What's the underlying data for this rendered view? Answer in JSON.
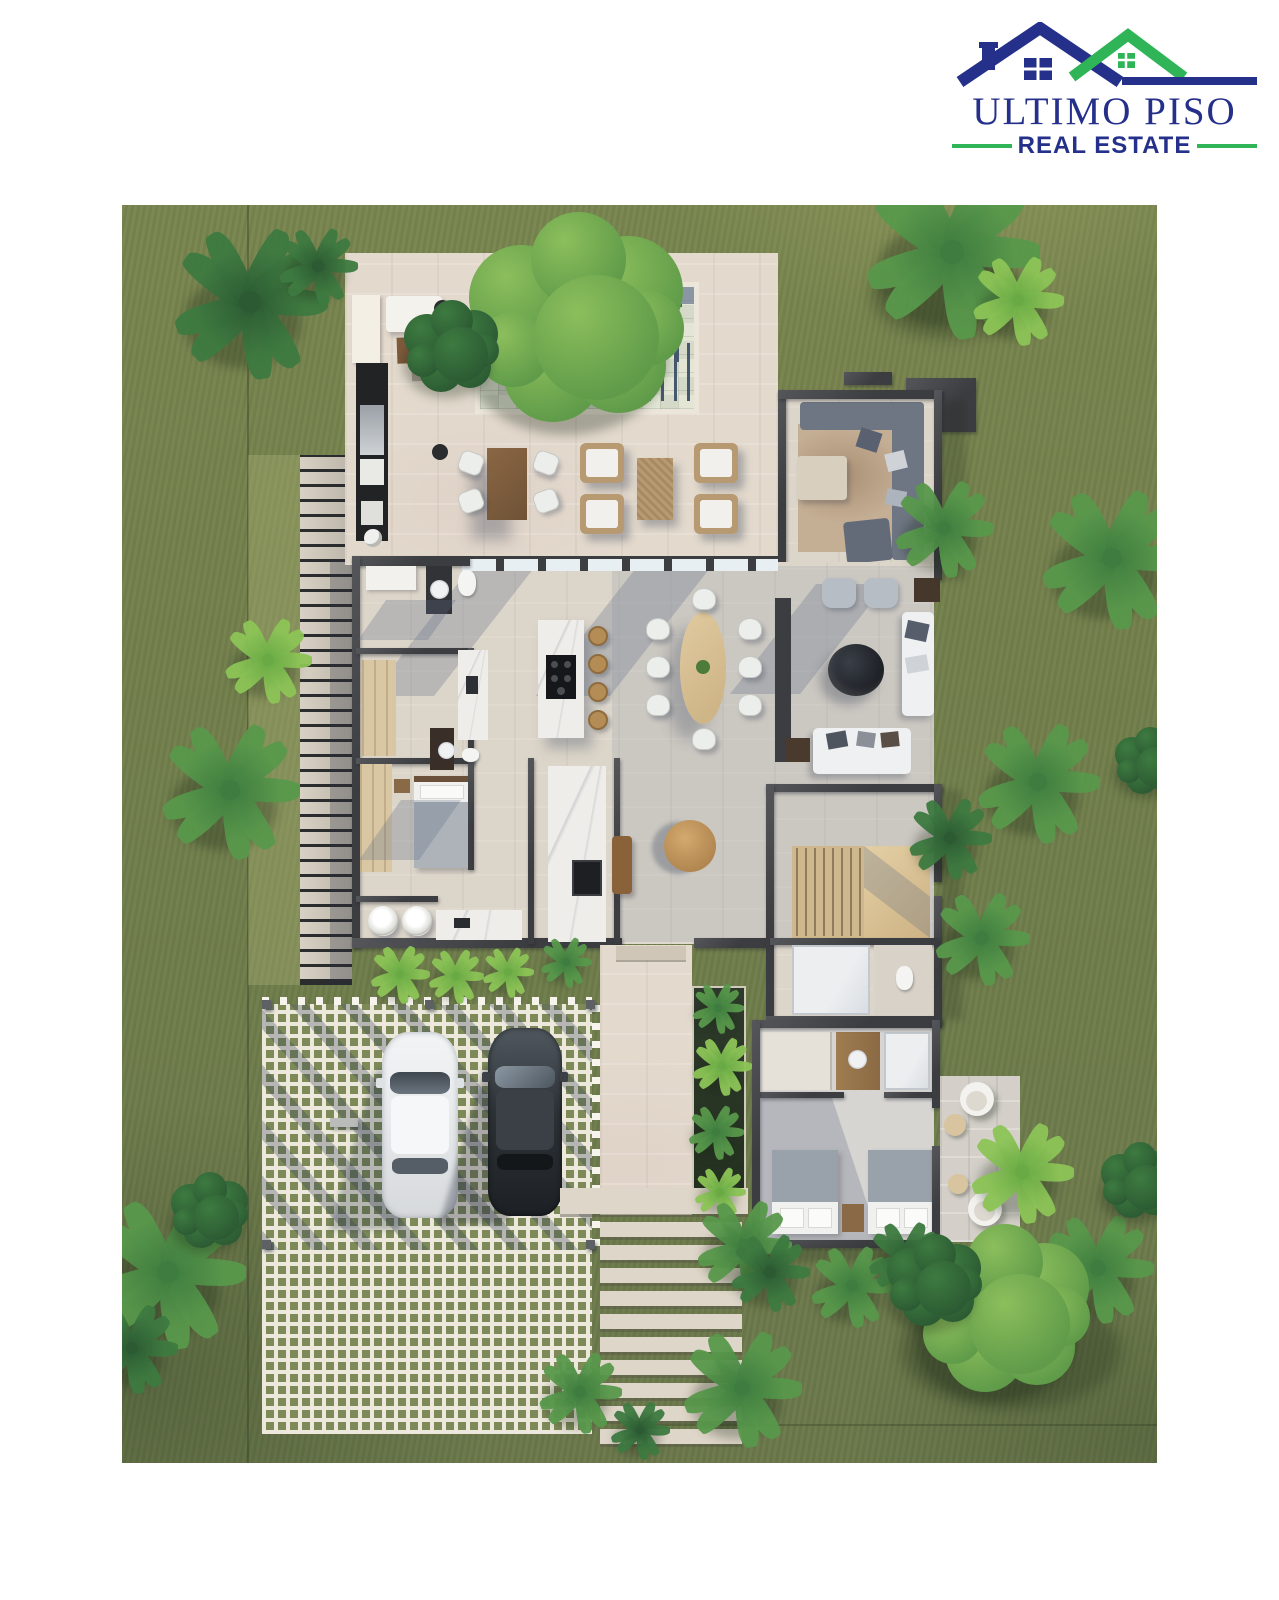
{
  "logo": {
    "title": "ULTIMO PISO",
    "tagline": "REAL ESTATE"
  },
  "palette": {
    "navy": "#25308a",
    "green": "#2fb457",
    "grass": "#75824d",
    "terrace": "#e3dacd",
    "floor": "#dcd5c9",
    "wall": "#3c3d40",
    "wood": "#8a6443",
    "lightwood": "#d5bd92",
    "marble": "#efedea",
    "water": "#dde0cf",
    "cushion": "#f1f0ec",
    "sofaGray": "#6e7683",
    "paverGreen": "#7d8a58",
    "paverLine": "#ece8db",
    "carDark": "#2d3237",
    "carWhite": "#e9ebed"
  },
  "scene": {
    "description": "Top-down 3D rendering of a villa floor plan with pool terrace, open-plan living, two bedrooms, carport with two cars and tropical garden",
    "palms": [
      {
        "x": 250,
        "y": 302,
        "r": 78,
        "tone": "dark"
      },
      {
        "x": 318,
        "y": 266,
        "r": 40,
        "tone": "dark"
      },
      {
        "x": 952,
        "y": 252,
        "r": 88,
        "tone": "mid"
      },
      {
        "x": 1018,
        "y": 300,
        "r": 46,
        "tone": "light"
      },
      {
        "x": 268,
        "y": 660,
        "r": 44,
        "tone": "light"
      },
      {
        "x": 230,
        "y": 790,
        "r": 70,
        "tone": "mid"
      },
      {
        "x": 944,
        "y": 528,
        "r": 50,
        "tone": "mid"
      },
      {
        "x": 1112,
        "y": 558,
        "r": 72,
        "tone": "mid"
      },
      {
        "x": 1038,
        "y": 782,
        "r": 62,
        "tone": "mid"
      },
      {
        "x": 950,
        "y": 838,
        "r": 42,
        "tone": "dark"
      },
      {
        "x": 982,
        "y": 938,
        "r": 48,
        "tone": "mid"
      },
      {
        "x": 1022,
        "y": 1172,
        "r": 52,
        "tone": "light"
      },
      {
        "x": 1098,
        "y": 1268,
        "r": 56,
        "tone": "mid"
      },
      {
        "x": 168,
        "y": 1272,
        "r": 78,
        "tone": "mid"
      },
      {
        "x": 132,
        "y": 1348,
        "r": 46,
        "tone": "dark"
      },
      {
        "x": 400,
        "y": 974,
        "r": 30,
        "tone": "light"
      },
      {
        "x": 456,
        "y": 976,
        "r": 28,
        "tone": "light"
      },
      {
        "x": 508,
        "y": 972,
        "r": 26,
        "tone": "light"
      },
      {
        "x": 566,
        "y": 962,
        "r": 26,
        "tone": "mid"
      },
      {
        "x": 718,
        "y": 1008,
        "r": 26,
        "tone": "mid"
      },
      {
        "x": 722,
        "y": 1066,
        "r": 30,
        "tone": "light"
      },
      {
        "x": 716,
        "y": 1132,
        "r": 28,
        "tone": "mid"
      },
      {
        "x": 720,
        "y": 1192,
        "r": 26,
        "tone": "light"
      },
      {
        "x": 744,
        "y": 1246,
        "r": 48,
        "tone": "mid"
      },
      {
        "x": 852,
        "y": 1286,
        "r": 42,
        "tone": "mid"
      },
      {
        "x": 770,
        "y": 1272,
        "r": 40,
        "tone": "dark"
      },
      {
        "x": 906,
        "y": 1258,
        "r": 38,
        "tone": "dark"
      },
      {
        "x": 742,
        "y": 1388,
        "r": 60,
        "tone": "mid"
      },
      {
        "x": 580,
        "y": 1392,
        "r": 42,
        "tone": "mid"
      },
      {
        "x": 640,
        "y": 1430,
        "r": 30,
        "tone": "dark"
      }
    ],
    "bushes": [
      {
        "x": 578,
        "y": 322,
        "r": 125,
        "tone": "tree"
      },
      {
        "x": 452,
        "y": 348,
        "r": 55,
        "tone": "dark"
      },
      {
        "x": 1005,
        "y": 1312,
        "r": 100,
        "tone": "tree"
      },
      {
        "x": 935,
        "y": 1282,
        "r": 55,
        "tone": "dark"
      },
      {
        "x": 1140,
        "y": 1182,
        "r": 45,
        "tone": "dark"
      },
      {
        "x": 210,
        "y": 1212,
        "r": 45,
        "tone": "dark"
      },
      {
        "x": 1150,
        "y": 762,
        "r": 40,
        "tone": "dark"
      }
    ],
    "boardwalk": {
      "count": 35
    },
    "stepsPath": {
      "count": 10
    },
    "poolSteps": {
      "count": 5
    },
    "stairTreads": {
      "count": 8
    },
    "diningChairs": [
      {
        "x": 657,
        "y": 628
      },
      {
        "x": 657,
        "y": 666
      },
      {
        "x": 657,
        "y": 704
      },
      {
        "x": 749,
        "y": 628
      },
      {
        "x": 749,
        "y": 666
      },
      {
        "x": 749,
        "y": 704
      },
      {
        "x": 703,
        "y": 598
      },
      {
        "x": 703,
        "y": 738
      }
    ],
    "terraceChairs": [
      {
        "x": 470,
        "y": 462
      },
      {
        "x": 470,
        "y": 500
      },
      {
        "x": 545,
        "y": 462
      },
      {
        "x": 545,
        "y": 500
      }
    ],
    "barStools": [
      {
        "x": 596,
        "y": 634
      },
      {
        "x": 596,
        "y": 662
      },
      {
        "x": 596,
        "y": 690
      },
      {
        "x": 596,
        "y": 718
      }
    ]
  }
}
